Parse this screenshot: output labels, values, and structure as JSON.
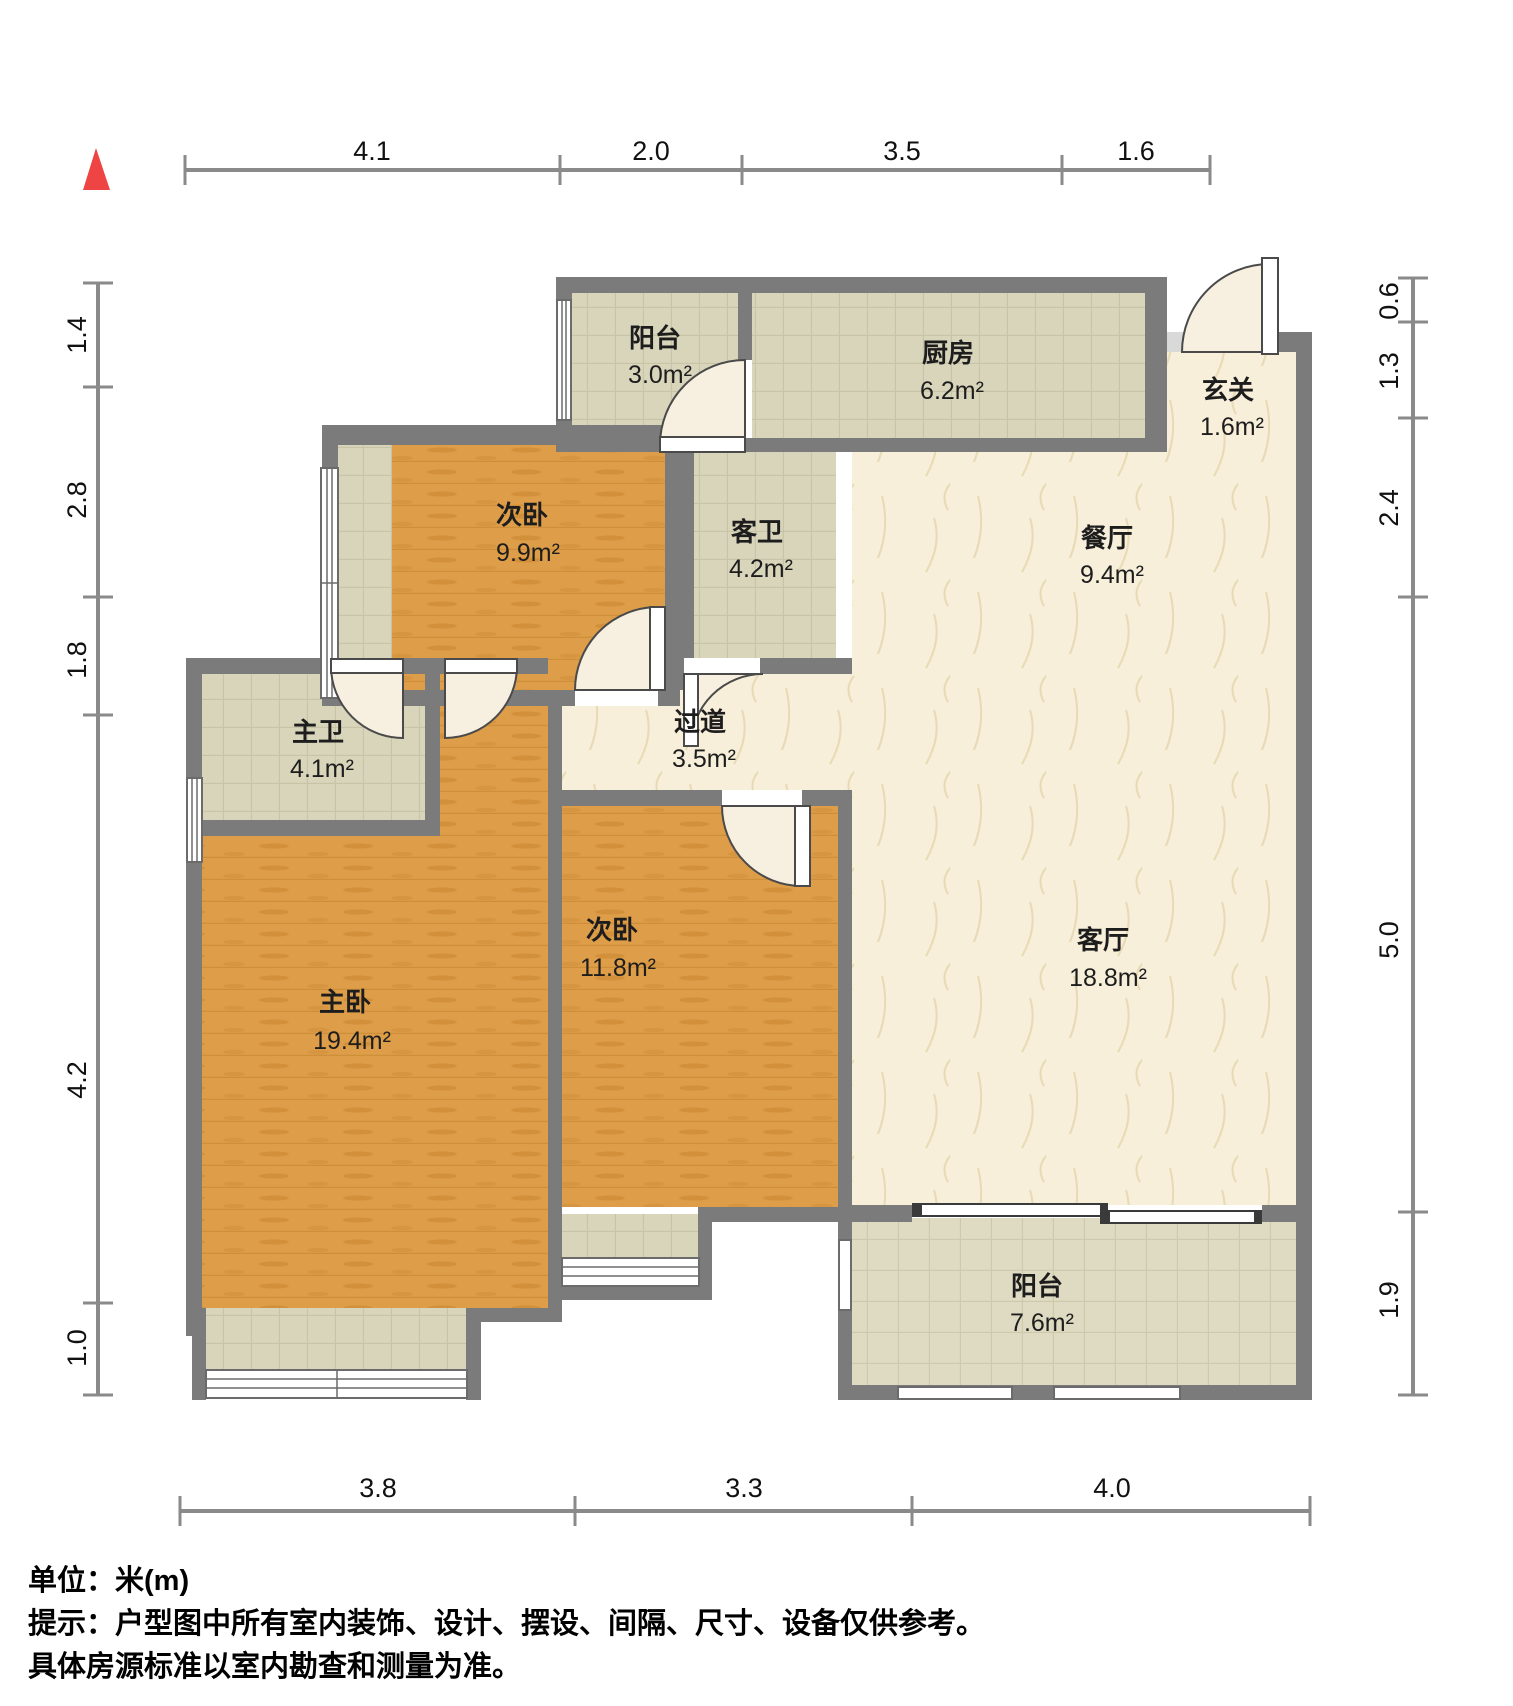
{
  "compass": {
    "name": "north-indicator",
    "color": "#ee4444"
  },
  "rooms": [
    {
      "id": "balcony-top",
      "name": "阳台",
      "area": "3.0m²"
    },
    {
      "id": "kitchen",
      "name": "厨房",
      "area": "6.2m²"
    },
    {
      "id": "entry-hall",
      "name": "玄关",
      "area": "1.6m²"
    },
    {
      "id": "bedroom-second-top",
      "name": "次卧",
      "area": "9.9m²"
    },
    {
      "id": "guest-bathroom",
      "name": "客卫",
      "area": "4.2m²"
    },
    {
      "id": "dining-room",
      "name": "餐厅",
      "area": "9.4m²"
    },
    {
      "id": "master-bathroom",
      "name": "主卫",
      "area": "4.1m²"
    },
    {
      "id": "corridor",
      "name": "过道",
      "area": "3.5m²"
    },
    {
      "id": "master-bedroom",
      "name": "主卧",
      "area": "19.4m²"
    },
    {
      "id": "bedroom-second-bottom",
      "name": "次卧",
      "area": "11.8m²"
    },
    {
      "id": "living-room",
      "name": "客厅",
      "area": "18.8m²"
    },
    {
      "id": "balcony-bottom",
      "name": "阳台",
      "area": "7.6m²"
    }
  ],
  "dimensions": {
    "top": [
      "4.1",
      "2.0",
      "3.5",
      "1.6"
    ],
    "left": [
      "1.4",
      "2.8",
      "1.8",
      "4.2",
      "1.0"
    ],
    "right": [
      "0.6",
      "1.3",
      "2.4",
      "5.0",
      "1.9"
    ],
    "bottom": [
      "3.8",
      "3.3",
      "4.0"
    ]
  },
  "footer": {
    "unit": "单位：米(m)",
    "tip": "提示：户型图中所有室内装饰、设计、摆设、间隔、尺寸、设备仅供参考。",
    "tip2": "具体房源标准以室内勘查和测量为准。"
  },
  "colors": {
    "wall": "#7b7b7b",
    "wood": "#dd9d49",
    "tile": "#d8d5bb",
    "marble": "#f7efda"
  }
}
